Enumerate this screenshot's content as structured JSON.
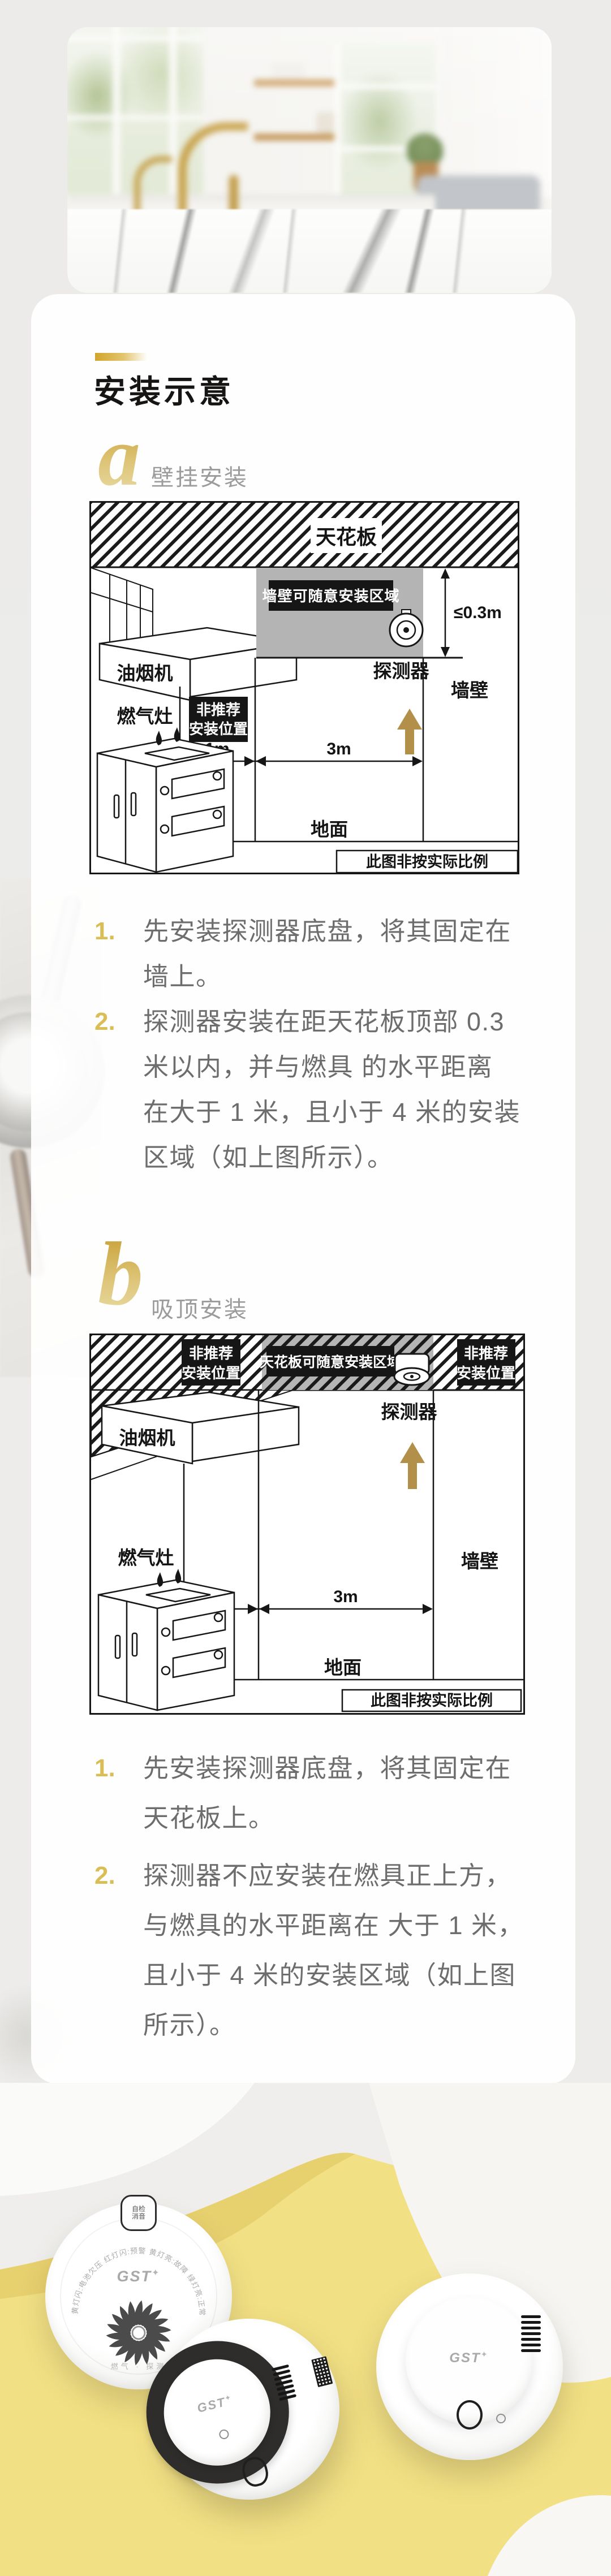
{
  "colors": {
    "page_bg": "#edecea",
    "card_bg": "rgba(255,255,255,0.93)",
    "accent_gold": "#d1a42c",
    "step_number_gold": "#d9bd55",
    "body_text_gray": "#6d6d6d",
    "diagram_ink": "#141414",
    "zone_gray": "#b4b4b4",
    "arrow_gold": "#b2904a",
    "wave_yellow": "#f2e084",
    "wave_yellow_dark": "#e7d06e"
  },
  "header": {
    "title": "安装示意"
  },
  "sections": [
    {
      "letter": "a",
      "label": "壁挂安装",
      "diagram": {
        "ceiling_label": "天花板",
        "zone_label": "墙壁可随意安装区域",
        "clearance": "≤0.3m",
        "detector_label": "探测器",
        "hood_label": "油烟机",
        "nr_line1": "非推荐",
        "nr_line2": "安装位置",
        "dim_1m": "1m",
        "dim_3m": "3m",
        "wall_label": "墙壁",
        "stove_label": "燃气灶",
        "floor_label": "地面",
        "scale_note": "此图非按实际比例"
      },
      "steps": [
        {
          "num": "1.",
          "lines": [
            "先安装探测器底盘，将其固定在",
            "墙上。"
          ]
        },
        {
          "num": "2.",
          "lines": [
            "探测器安装在距天花板顶部 0.3",
            "米以内，并与燃具 的水平距离",
            "在大于 1 米，且小于 4 米的安装",
            "区域（如上图所示）。"
          ]
        }
      ]
    },
    {
      "letter": "b",
      "label": "吸顶安装",
      "diagram": {
        "zone_label": "天花板可随意安装区域",
        "nr_line1": "非推荐",
        "nr_line2": "安装位置",
        "detector_label": "探测器",
        "hood_label": "油烟机",
        "dim_1m": "1m",
        "dim_3m": "3m",
        "wall_label": "墙壁",
        "stove_label": "燃气灶",
        "floor_label": "地面",
        "scale_note": "此图非按实际比例"
      },
      "steps": [
        {
          "num": "1.",
          "lines": [
            "先安装探测器底盘，将其固定在",
            "天花板上。"
          ]
        },
        {
          "num": "2.",
          "lines": [
            "探测器不应安装在燃具正上方，",
            "与燃具的水平距离在 大于 1 米，",
            "且小于 4 米的安装区域（如上图",
            "所示）。"
          ]
        }
      ]
    }
  ],
  "products": {
    "brand": "GST",
    "back_unit": {
      "button_line1": "自检",
      "button_line2": "消音",
      "arc_text": "黄灯闪:电池欠压 红灯闪:预警 黄灯亮:故障 绿灯亮:正常",
      "foot_text": "燃气 · 探测"
    }
  }
}
